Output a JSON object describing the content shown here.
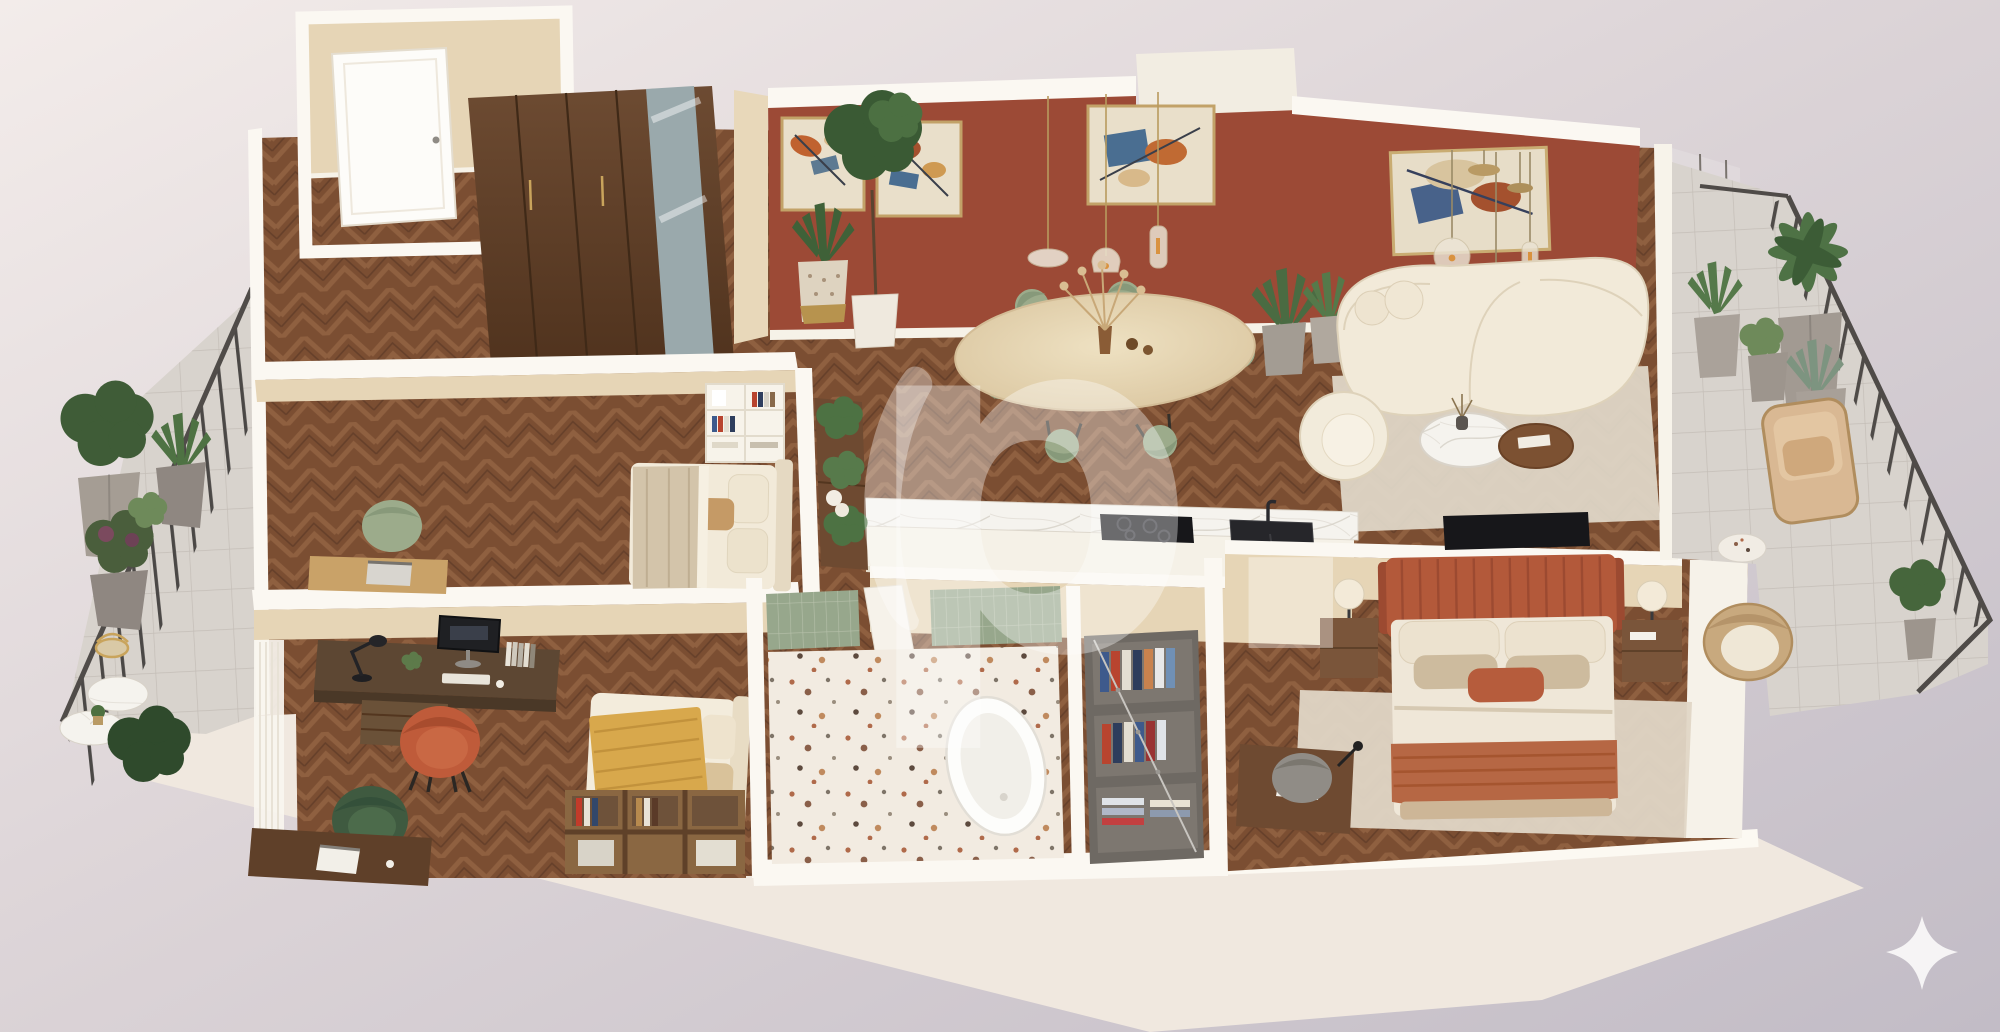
{
  "meta": {
    "description": "3D axonometric cutaway floor plan render of a furnished one-bedroom-plus apartment",
    "render_style": "photoreal top-down cutaway",
    "background": "pink-gray gradient backdrop"
  },
  "watermark": {
    "glyph": "p.",
    "opacity": 0.36
  },
  "sparkle": {
    "shape": "four-point-star",
    "color": "#faf8f7"
  },
  "palette": {
    "bg_light": "#f2ebe9",
    "bg_dark": "#c5bfc8",
    "fascia": "#f0e8df",
    "wall_white": "#fbf8f2",
    "wall_beige": "#e6d5b6",
    "accent_terracotta": "#9c4a36",
    "floor_wood": "#7b4e32",
    "wood_dark": "#5f4029",
    "walnut": "#6e4a31",
    "marble": "#f5f3ee",
    "sage": "#9cab8b",
    "cream_boucle": "#f2ead9",
    "rust": "#b3593a",
    "mustard": "#d8a84c",
    "tile_green": "#97a78c",
    "terrazzo": "#f2ebe1",
    "tile_gray": "#d8d3cd",
    "railing": "#4b4846",
    "brass": "#b99a64",
    "plant_green": "#4c7042",
    "rug_beige": "#e2dacb"
  },
  "rooms": [
    {
      "name": "entry-hall",
      "floor": "herringbone-wood",
      "items": [
        "front-door",
        "beige-walls"
      ]
    },
    {
      "name": "hallway",
      "floor": "herringbone-wood",
      "items": [
        "walnut-wardrobe",
        "mirror-doors",
        "plant-console",
        "white-shelf-unit"
      ]
    },
    {
      "name": "living-dining-room",
      "accent_wall": "terracotta",
      "items": [
        "abstract-art-x4",
        "glass-pendant-lights",
        "oval-travertine-dining-table",
        "sage-dining-chairs-x6",
        "boucle-curved-sofa",
        "boucle-armchair",
        "marble-coffee-table",
        "walnut-coffee-table",
        "area-rug",
        "tv-on-half-wall",
        "potted-plants"
      ]
    },
    {
      "name": "kitchen",
      "items": [
        "marble-island",
        "induction-hob",
        "black-sink",
        "faucet"
      ]
    },
    {
      "name": "guest-bedroom",
      "items": [
        "double-bed",
        "tan-throw",
        "sage-armchair",
        "writing-desk-with-laptop",
        "shelf-unit"
      ]
    },
    {
      "name": "kids-room-office",
      "items": [
        "walnut-desk",
        "computer-monitor",
        "black-desk-lamp",
        "books",
        "terracotta-chair",
        "green-velvet-chair",
        "single-bed-mustard-throw",
        "cubby-bookshelf",
        "laptop-sideboard",
        "sheer-curtains"
      ]
    },
    {
      "name": "bathroom",
      "items": [
        "green-tile-shower-walls",
        "terrazzo-floor",
        "freestanding-bathtub",
        "white-door"
      ]
    },
    {
      "name": "walk-in-closet",
      "items": [
        "open-wardrobe",
        "hanging-clothes",
        "folded-clothes",
        "vanity-desk",
        "gray-chair"
      ]
    },
    {
      "name": "master-bedroom",
      "items": [
        "terracotta-channel-headboard-bed",
        "beige-bedding",
        "rust-throw",
        "nightstand-left",
        "nightstand-right",
        "table-lamps",
        "area-rug"
      ]
    },
    {
      "name": "left-balcony",
      "items": [
        "metal-railing",
        "faceted-planters-x4",
        "gold-bistro-chair",
        "marble-bistro-tables",
        "floor-plants"
      ]
    },
    {
      "name": "right-terrace",
      "items": [
        "metal-railing",
        "palm-planter",
        "succulent-planters",
        "rattan-lounge-chair",
        "terrazzo-side-table",
        "rattan-armchair",
        "small-tree"
      ]
    }
  ]
}
